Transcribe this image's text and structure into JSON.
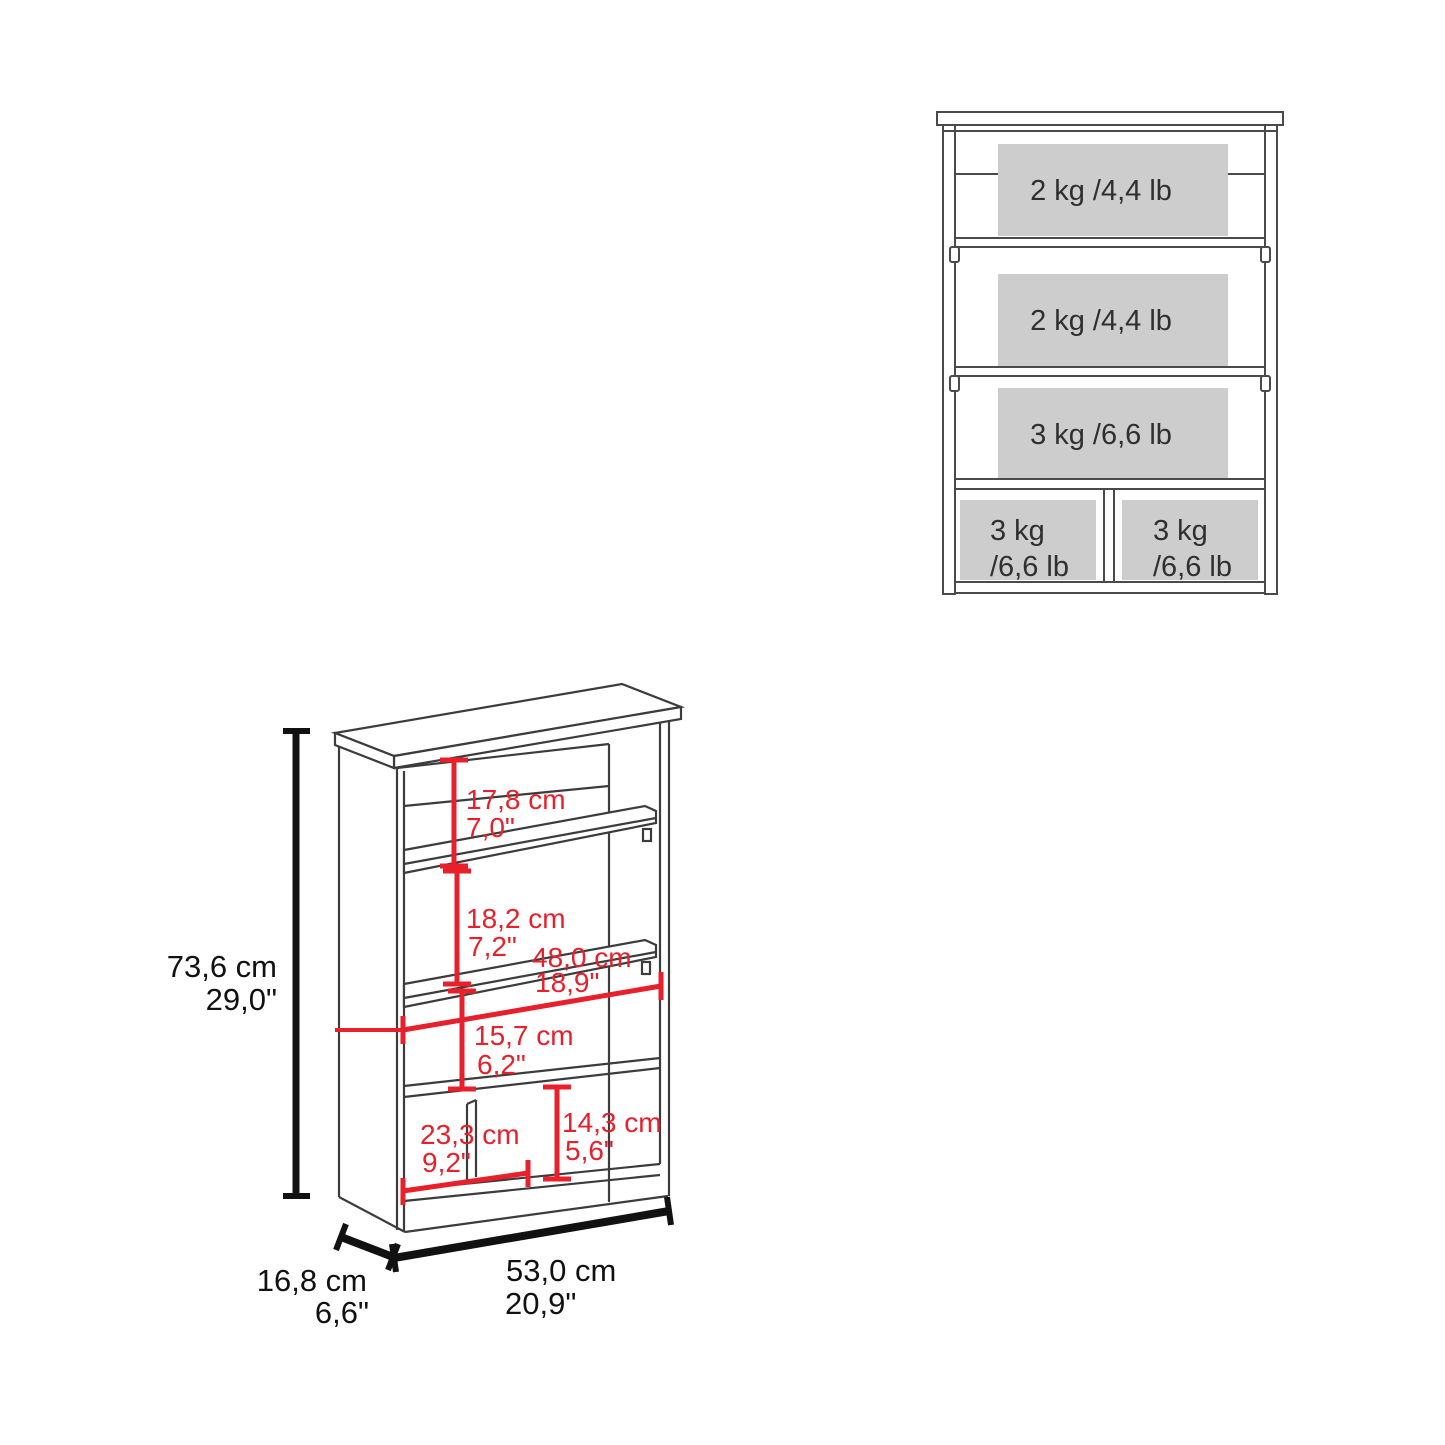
{
  "front_view": {
    "shelves": [
      {
        "capacity": "2 kg /4,4 lb"
      },
      {
        "capacity": "2 kg /4,4 lb"
      },
      {
        "capacity": "3 kg /6,6 lb"
      }
    ],
    "cubbies": [
      {
        "line1": "3 kg",
        "line2": "/6,6 lb"
      },
      {
        "line1": "3 kg",
        "line2": "/6,6 lb"
      }
    ]
  },
  "dimension_view": {
    "overall_height": {
      "cm": "73,6 cm",
      "in": "29,0\""
    },
    "depth": {
      "cm": "16,8 cm",
      "in": "6,6\""
    },
    "overall_width": {
      "cm": "53,0 cm",
      "in": "20,9\""
    },
    "opening_top": {
      "cm": "17,8 cm",
      "in": "7,0\""
    },
    "opening_middle": {
      "cm": "18,2 cm",
      "in": "7,2\""
    },
    "inner_width": {
      "cm": "48,0 cm",
      "in": "18,9\""
    },
    "opening_lower": {
      "cm": "15,7 cm",
      "in": "6,2\""
    },
    "cubby_width": {
      "cm": "23,3 cm",
      "in": "9,2\""
    },
    "cubby_height": {
      "cm": "14,3 cm",
      "in": "5,6\""
    }
  },
  "colors": {
    "dimension_red": "#e8202b",
    "dimension_black": "#111111",
    "outline_gray": "#4a4a4a",
    "shade_gray": "#cdcdcd"
  }
}
